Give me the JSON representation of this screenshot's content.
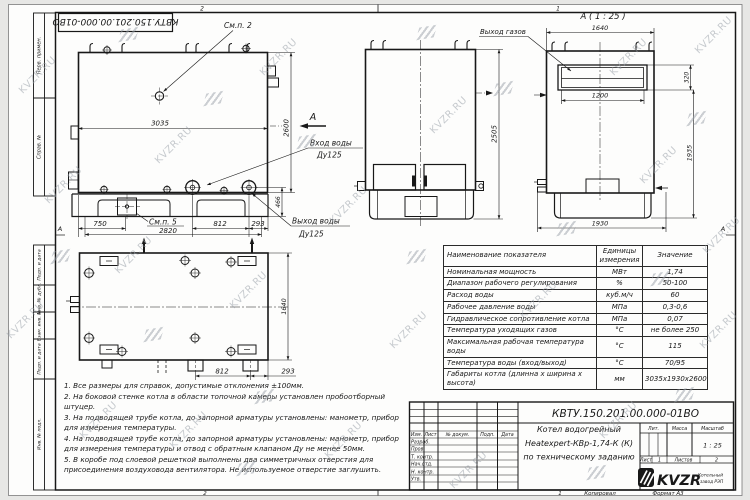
{
  "watermark": {
    "text": "KVZR.RU"
  },
  "frame": {
    "doc_number_flipped": "КВТУ.150.201.00.000-01ВО",
    "zone_top_left": "2",
    "zone_top_right": "1",
    "zone_bottom_left": "2",
    "zone_bottom_right": "1",
    "zone_row_left": "А",
    "zone_row_right": "А",
    "stamps": {
      "perv_primen": "Перв. примен.",
      "sprav_no": "Справ. №",
      "podp_data_1": "Подп. и дата",
      "inv_no_dubl": "Инв. № дубл.",
      "vzam_inv_no": "Взам. инв. №",
      "podp_data_2": "Подп. и дата",
      "inv_no_podl": "Инв. № подл."
    },
    "kopiroval": "Копировал",
    "format": "Формат А3"
  },
  "views": {
    "side": {
      "callout_2": "См.п. 2",
      "callout_5": "См.п. 5",
      "section_letter": "А",
      "water_in_1": "Вход воды",
      "water_in_2": "Ду125",
      "water_out_1": "Выход воды",
      "water_out_2": "Ду125",
      "dim_3035": "3035",
      "dim_2600": "2600",
      "dim_466": "466",
      "dim_750": "750",
      "dim_2820": "2820",
      "dim_812": "812",
      "dim_293": "293"
    },
    "front": {
      "dim_2505": "2505"
    },
    "section_a": {
      "title": "А ( 1 : 25 )",
      "gas_out": "Выход газов",
      "dim_1640": "1640",
      "dim_1200": "1200",
      "dim_320": "320",
      "dim_1935": "1935",
      "dim_1930": "1930"
    },
    "plan": {
      "dim_1640": "1640",
      "dim_812": "812",
      "dim_293": "293"
    }
  },
  "spec_table": {
    "col_name": "Наименование показателя",
    "col_unit": "Единицы измерения",
    "col_value": "Значение",
    "rows": [
      {
        "name": "Номинальная мощность",
        "unit": "МВт",
        "value": "1,74"
      },
      {
        "name": "Диапазон рабочего регулирования",
        "unit": "%",
        "value": "50-100"
      },
      {
        "name": "Расход воды",
        "unit": "куб.м/ч",
        "value": "60"
      },
      {
        "name": "Рабочее давление воды",
        "unit": "МПа",
        "value": "0,3-0,6"
      },
      {
        "name": "Гидравлическое сопротивление котла",
        "unit": "МПа",
        "value": "0,07"
      },
      {
        "name": "Температура уходящих газов",
        "unit": "°С",
        "value": "не более 250"
      },
      {
        "name": "Максимальная рабочая температура воды",
        "unit": "°С",
        "value": "115"
      },
      {
        "name": "Температура воды (вход/выход)",
        "unit": "°С",
        "value": "70/95"
      },
      {
        "name": "Габариты котла (длинна х ширина х высота)",
        "unit": "мм",
        "value": "3035х1930х2600"
      }
    ]
  },
  "notes": [
    "1. Все размеры для справок, допустимые отклонения ±100мм.",
    "2. На боковой стенке котла в области топочной камеры установлен пробоотборный штуцер.",
    "3. На подводящей трубе котла, до запорной арматуры установлены: манометр, прибор для измерения температуры.",
    "4. На подводящей трубе котла, до запорной арматуры установлены: манометр, прибор для измерения температуры и отвод с обратным клапаном Ду не менее 50мм.",
    "5. В коробе под слоевой решеткой выполнены два симметричных отверстия для присоединения воздуховода вентилятора. Не используемое отверстие заглушить."
  ],
  "title_block": {
    "doc_number": "КВТУ.150.201.00.000-01ВО",
    "product_1": "Котел водогрейный",
    "product_2": "Heatexpert-КВр-1,74-К (К)",
    "product_3": "по техническому заданию",
    "col_izm": "Изм.",
    "col_list": "Лист",
    "col_dokum": "№ докум.",
    "col_podp": "Подп.",
    "col_data": "Дата",
    "row_razrab": "Разраб.",
    "row_prov": "Пров.",
    "row_tkontr": "Т. контр.",
    "row_nachotd": "Нач.отд.",
    "row_nkontr": "Н. контр.",
    "row_utv": "Утв.",
    "lit": "Лит.",
    "massa": "Масса",
    "masshtab": "Масштаб",
    "scale": "1 : 25",
    "sheet_label": "Лист",
    "sheet_no": "1",
    "sheets_label": "Листов",
    "sheets_total": "2",
    "logo": "KVZR",
    "logo_sub_1": "Котельный",
    "logo_sub_2": "завод РЭП"
  }
}
